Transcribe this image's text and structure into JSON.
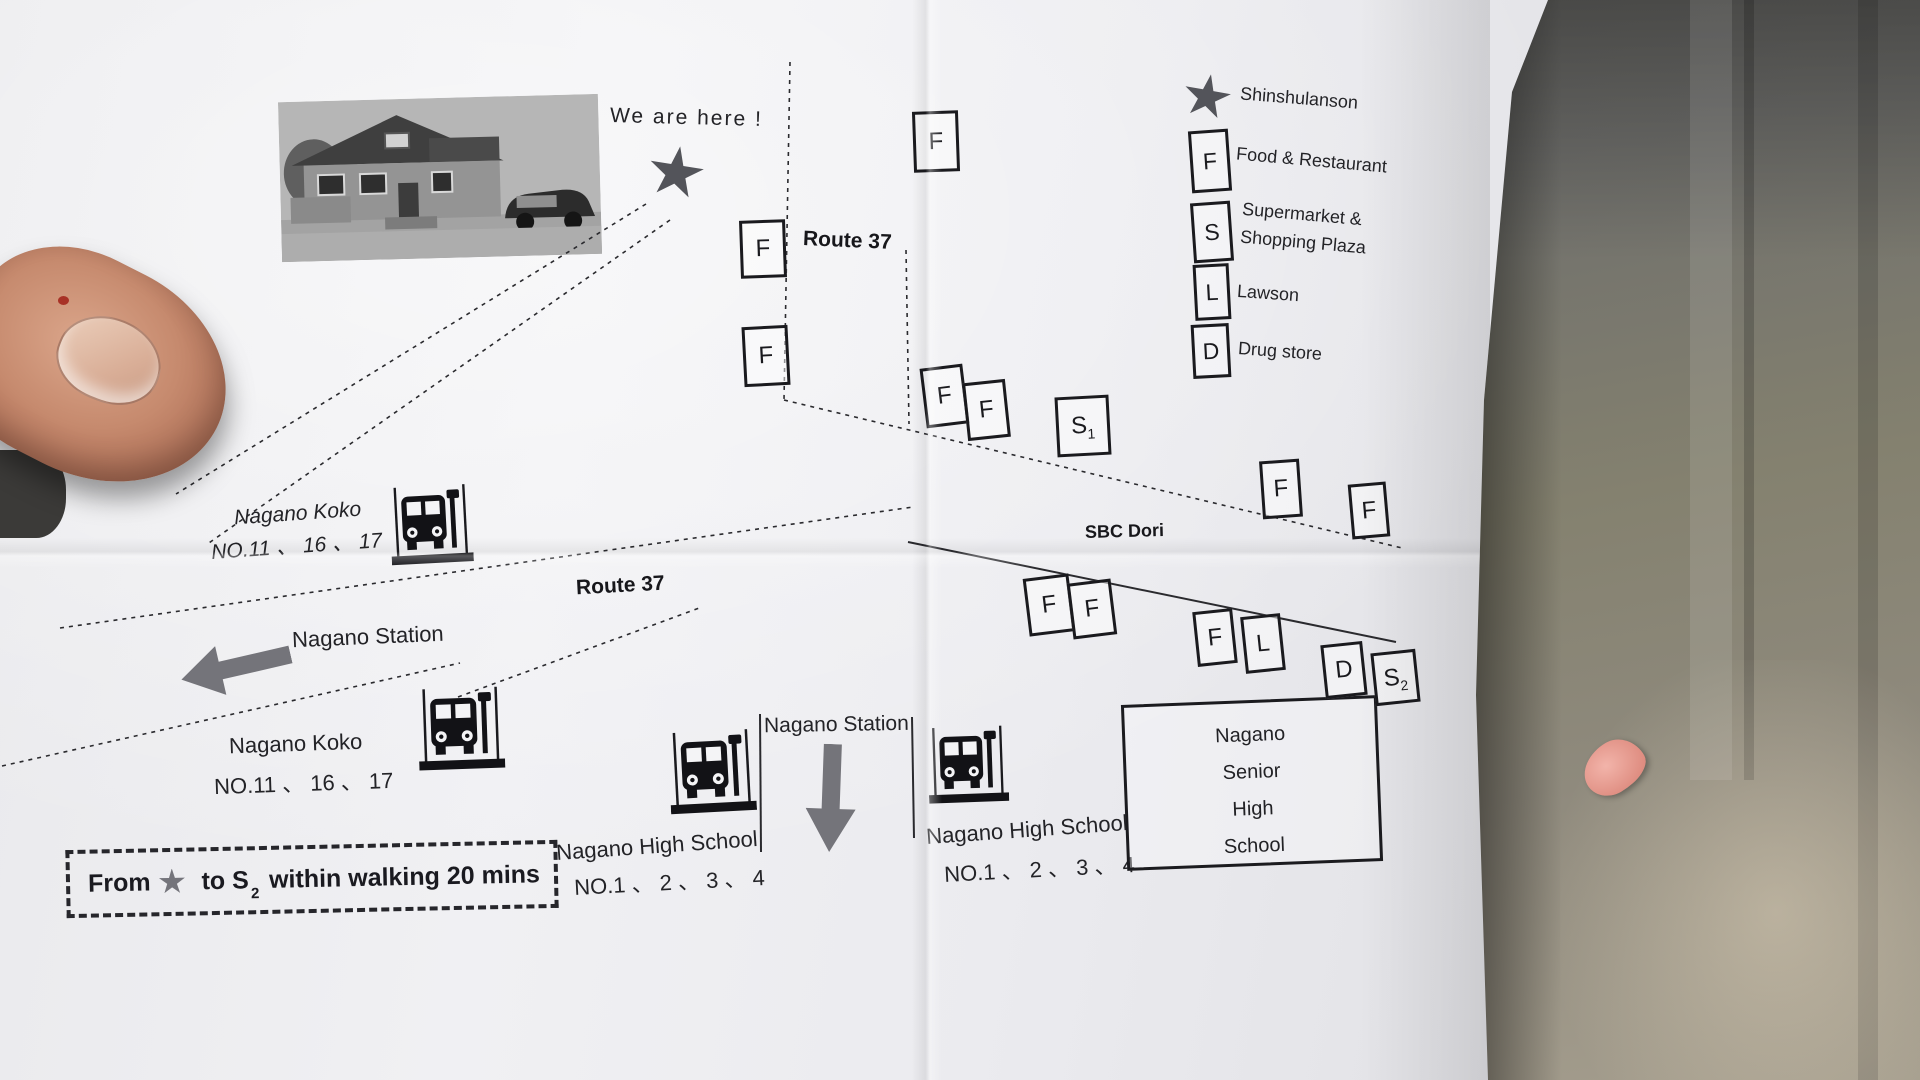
{
  "map": {
    "we_are_here": "We are here !",
    "route37_top": "Route 37",
    "route37_mid": "Route 37",
    "sbc_dori": "SBC Dori",
    "nagano_station_left": "Nagano Station",
    "nagano_station_mid": "Nagano Station",
    "bus_stops": {
      "koko_upper": {
        "line1": "Nagano Koko",
        "line2": "NO.11 、 16 、 17"
      },
      "koko_lower": {
        "line1": "Nagano Koko",
        "line2": "NO.11 、 16 、 17"
      },
      "hs_left": {
        "line1": "Nagano High School",
        "line2": "NO.1 、 2 、 3 、 4"
      },
      "hs_right": {
        "line1": "Nagano High School",
        "line2": "NO.1 、 2 、 3 、 4"
      }
    },
    "senior_school": {
      "line1": "Nagano",
      "line2": "Senior",
      "line3": "High",
      "line4": "School"
    },
    "note": {
      "p1": "From",
      "p2": "to S",
      "sub": "2",
      "p3": "within walking 20 mins"
    },
    "markers": [
      {
        "letter": "F",
        "sub": "",
        "x": 913,
        "y": 111,
        "w": 40,
        "h": 55,
        "rot": -2
      },
      {
        "letter": "F",
        "sub": "",
        "x": 740,
        "y": 220,
        "w": 40,
        "h": 52,
        "rot": -2
      },
      {
        "letter": "F",
        "sub": "",
        "x": 743,
        "y": 326,
        "w": 40,
        "h": 54,
        "rot": -3
      },
      {
        "letter": "F",
        "sub": "",
        "x": 923,
        "y": 366,
        "w": 37,
        "h": 54,
        "rot": -7
      },
      {
        "letter": "F",
        "sub": "",
        "x": 965,
        "y": 381,
        "w": 37,
        "h": 52,
        "rot": -6
      },
      {
        "letter": "S",
        "sub": "1",
        "x": 1056,
        "y": 396,
        "w": 48,
        "h": 54,
        "rot": -3
      },
      {
        "letter": "F",
        "sub": "",
        "x": 1261,
        "y": 460,
        "w": 34,
        "h": 52,
        "rot": -4
      },
      {
        "letter": "F",
        "sub": "",
        "x": 1350,
        "y": 483,
        "w": 32,
        "h": 49,
        "rot": -5
      },
      {
        "letter": "F",
        "sub": "",
        "x": 1026,
        "y": 576,
        "w": 40,
        "h": 52,
        "rot": -7
      },
      {
        "letter": "F",
        "sub": "",
        "x": 1070,
        "y": 581,
        "w": 38,
        "h": 50,
        "rot": -7
      },
      {
        "letter": "F",
        "sub": "",
        "x": 1195,
        "y": 610,
        "w": 34,
        "h": 49,
        "rot": -6
      },
      {
        "letter": "L",
        "sub": "",
        "x": 1243,
        "y": 615,
        "w": 34,
        "h": 51,
        "rot": -6
      },
      {
        "letter": "D",
        "sub": "",
        "x": 1323,
        "y": 643,
        "w": 36,
        "h": 48,
        "rot": -6
      },
      {
        "letter": "S",
        "sub": "2",
        "x": 1373,
        "y": 651,
        "w": 39,
        "h": 47,
        "rot": -6
      }
    ],
    "roads": [
      {
        "x1": 790,
        "y1": 62,
        "x2": 784,
        "y2": 400,
        "dash": true
      },
      {
        "x1": 906,
        "y1": 250,
        "x2": 909,
        "y2": 424,
        "dash": true
      },
      {
        "x1": 646,
        "y1": 204,
        "x2": 176,
        "y2": 494,
        "dash": true
      },
      {
        "x1": 670,
        "y1": 220,
        "x2": 206,
        "y2": 545,
        "dash": true
      },
      {
        "x1": 784,
        "y1": 400,
        "x2": 1402,
        "y2": 548,
        "dash": true
      },
      {
        "x1": 908,
        "y1": 542,
        "x2": 1396,
        "y2": 642,
        "dash": false
      },
      {
        "x1": 60,
        "y1": 628,
        "x2": 913,
        "y2": 507,
        "dash": true
      },
      {
        "x1": 2,
        "y1": 766,
        "x2": 460,
        "y2": 663,
        "dash": true
      },
      {
        "x1": 458,
        "y1": 697,
        "x2": 702,
        "y2": 607,
        "dash": true
      },
      {
        "x1": 760,
        "y1": 714,
        "x2": 761,
        "y2": 852,
        "dash": false
      },
      {
        "x1": 912,
        "y1": 717,
        "x2": 914,
        "y2": 838,
        "dash": false
      }
    ]
  },
  "legend": {
    "star_label": "Shinshulanson",
    "f_letter": "F",
    "f_label": "Food & Restaurant",
    "s_letter": "S",
    "s_label1": "Supermarket &",
    "s_label2": "Shopping Plaza",
    "l_letter": "L",
    "l_label": "Lawson",
    "d_letter": "D",
    "d_label": "Drug store"
  },
  "colors": {
    "ink": "#1a1a1e",
    "paper": "#ebebee",
    "halftone_gray": "#74747a",
    "concrete": "#8b887c"
  }
}
